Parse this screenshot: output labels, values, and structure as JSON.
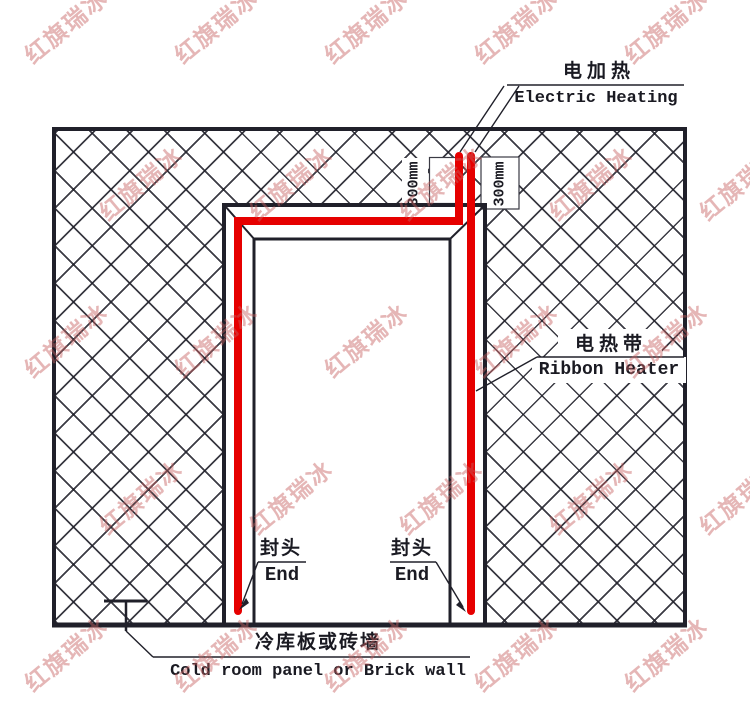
{
  "diagram": {
    "labels": {
      "electric_heating": {
        "cn": "电加热",
        "en": "Electric Heating"
      },
      "ribbon_heater": {
        "cn": "电热带",
        "en": "Ribbon Heater"
      },
      "end_left": {
        "cn": "封头",
        "en": "End"
      },
      "end_right": {
        "cn": "封头",
        "en": "End"
      },
      "wall": {
        "cn": "冷库板或砖墙",
        "en": "Cold room panel or Brick wall"
      }
    },
    "dimensions": {
      "lead_left": "300mm",
      "lead_right": "300mm"
    },
    "watermark": {
      "text": "红旗瑞冰"
    },
    "colors": {
      "heater_red": "#e60000",
      "line": "#20202a",
      "watermark": "#c76060"
    }
  }
}
